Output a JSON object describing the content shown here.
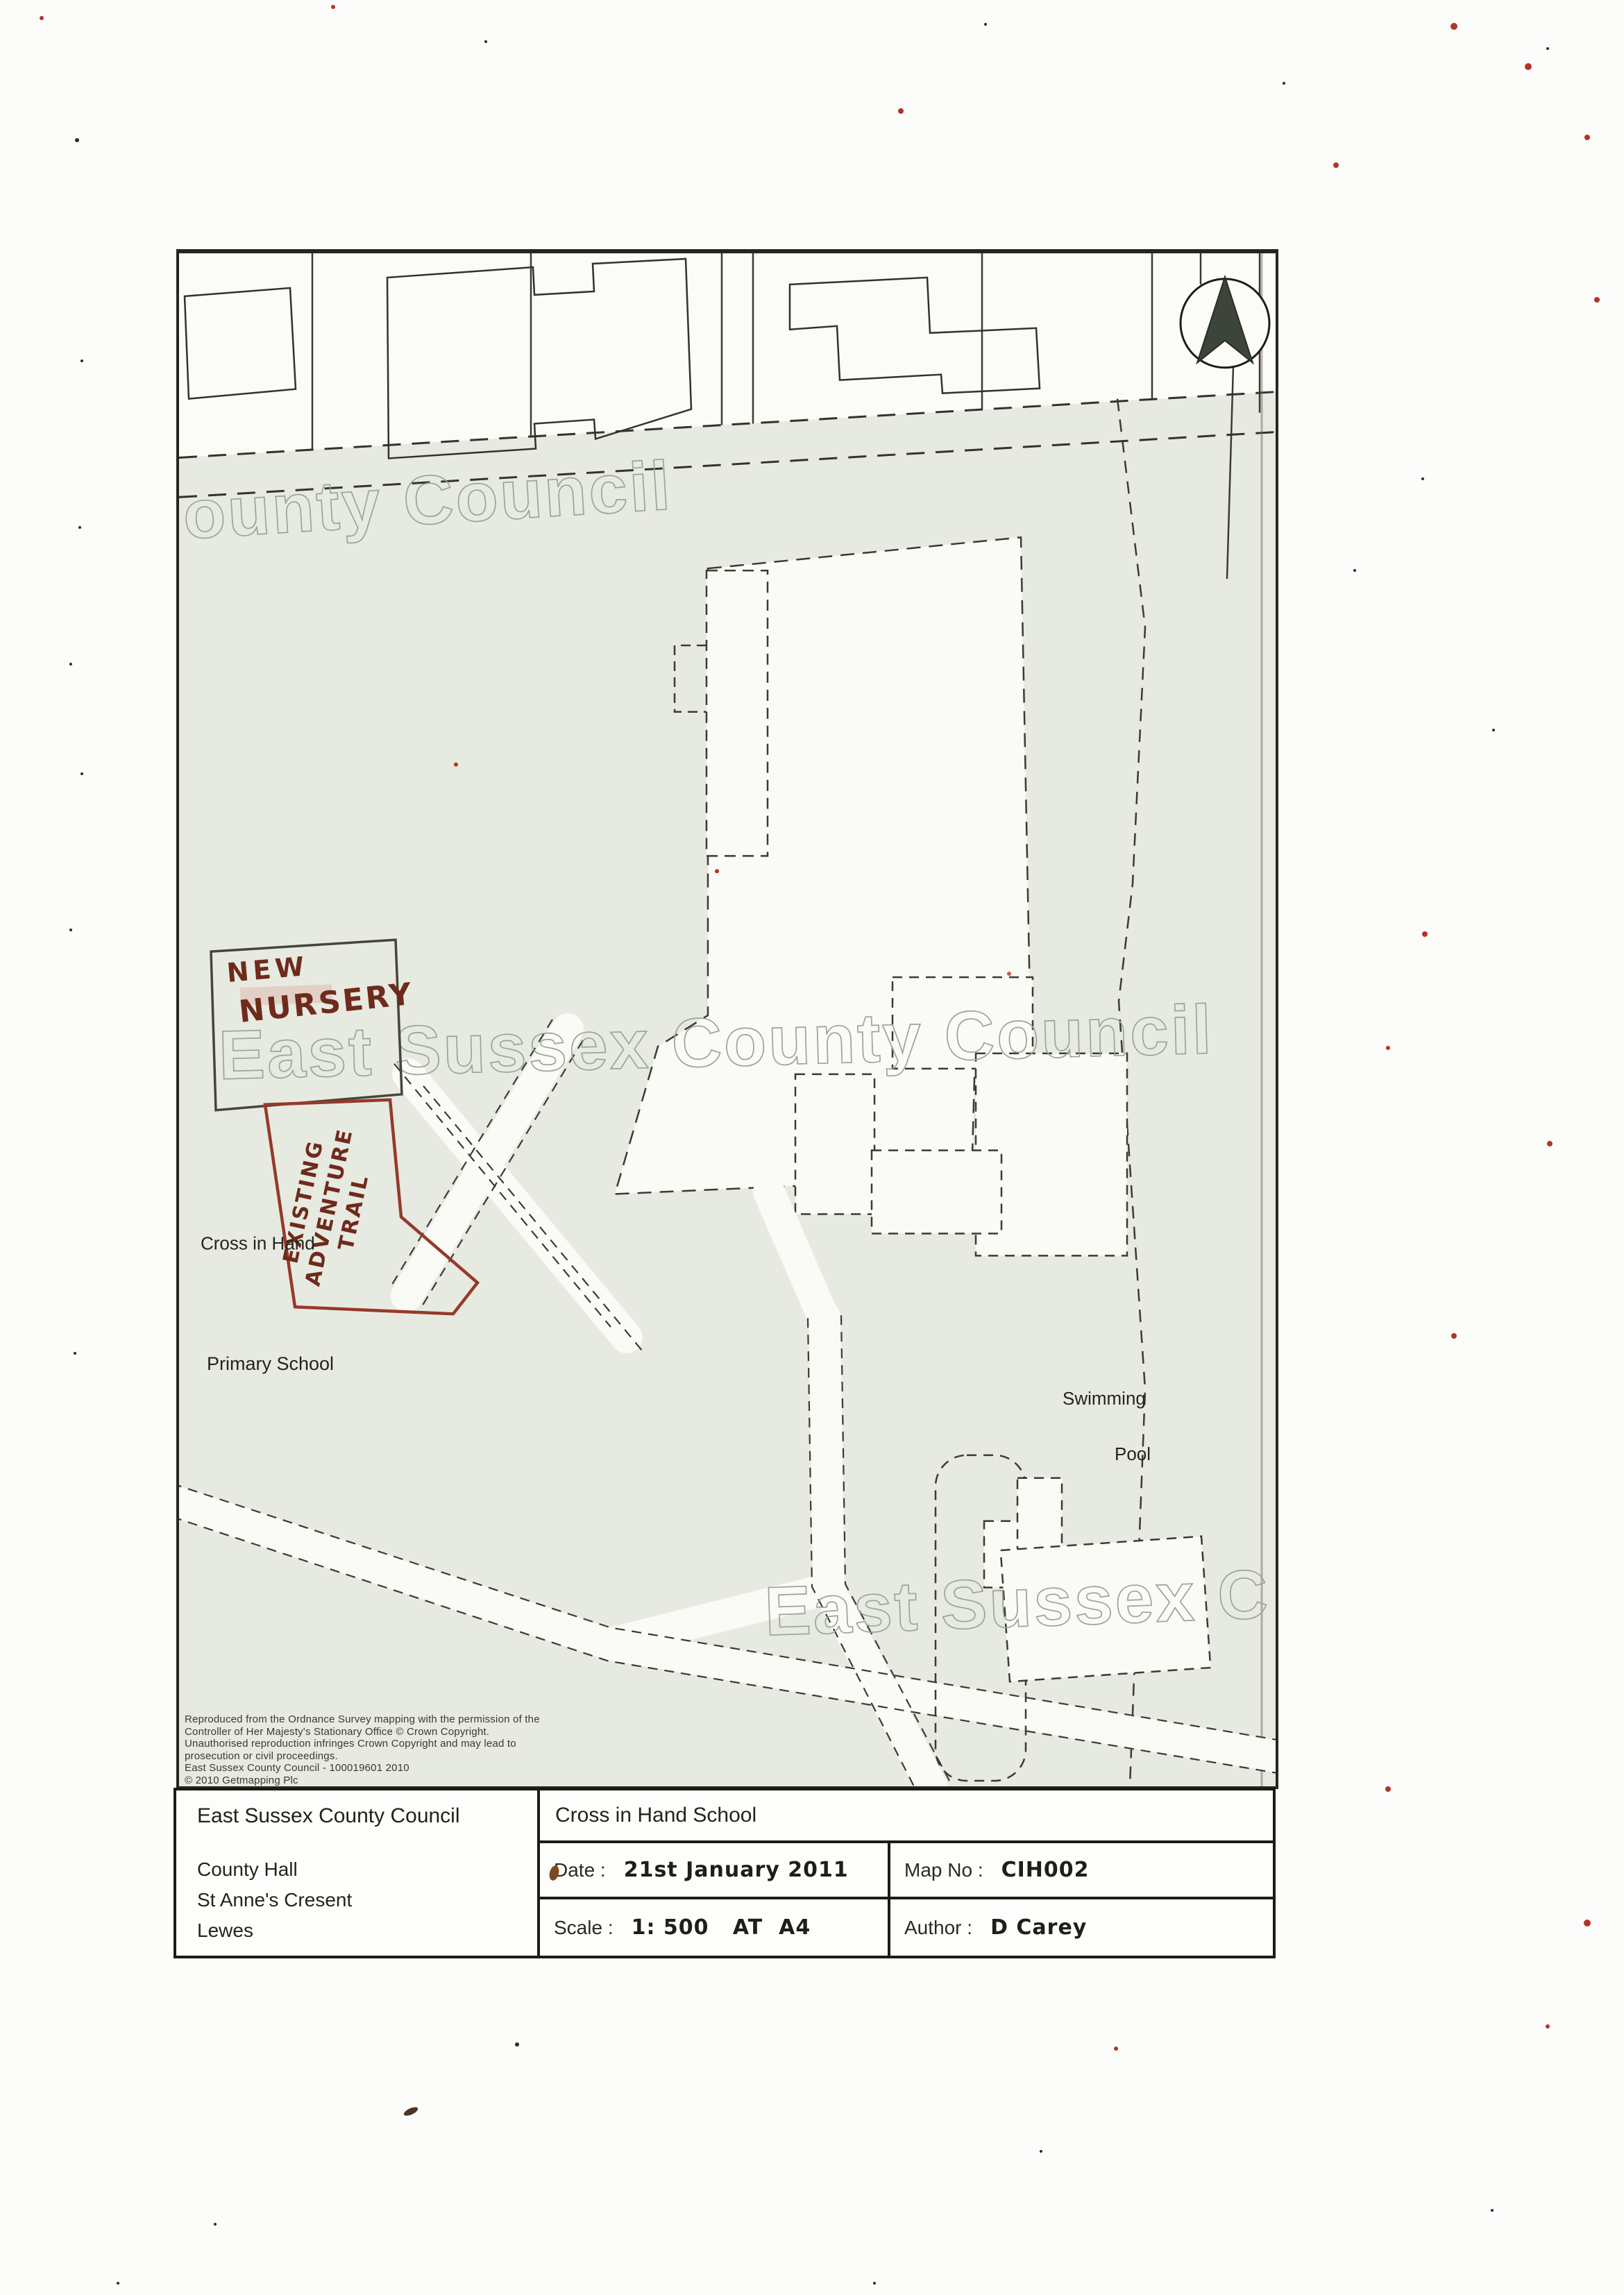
{
  "map": {
    "watermarks": {
      "top": "ounty Council",
      "middle": "East Sussex County Council",
      "bottom": "East Sussex C"
    },
    "labels": {
      "cross_in_hand": "Cross in Hand",
      "primary_school": "Primary School",
      "swimming": "Swimming",
      "pool": "Pool"
    },
    "annotations": {
      "nursery_line1": "NEW",
      "nursery_line2": "NURSERY",
      "trail_line1": "EXISTING",
      "trail_line2": "ADVENTURE",
      "trail_line3": "TRAIL",
      "ink_color": "#6f2a1c",
      "trail_outline_color": "#96392a"
    },
    "copyright": [
      "Reproduced from the Ordnance Survey mapping with the permission of the",
      "Controller of Her Majesty's Stationary Office © Crown Copyright.",
      "Unauthorised reproduction infringes Crown Copyright and may lead to",
      "prosecution or civil proceedings.",
      "East Sussex County Council - 100019601 2010",
      "© 2010 Getmapping Plc"
    ]
  },
  "title_block": {
    "org": "East Sussex County Council",
    "address1": "County Hall",
    "address2": "St Anne's Cresent",
    "address3": "Lewes",
    "project": "Cross in Hand School",
    "date_label": "Date :",
    "date_value": "21st January 2011",
    "mapno_label": "Map No :",
    "mapno_value": "CIH002",
    "scale_label": "Scale :",
    "scale_value": "1: 500   AT  A4",
    "author_label": "Author :",
    "author_value": "D Carey"
  },
  "colors": {
    "ground_tint": "#e7eae1",
    "annotation_red": "#96392a",
    "watermark_grey": "#9ba49a"
  }
}
